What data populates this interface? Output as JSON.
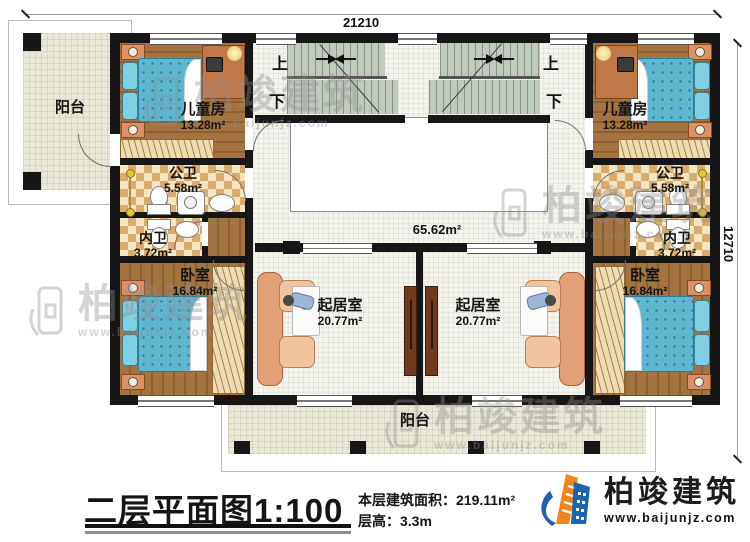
{
  "dimensions": {
    "top": "21210",
    "right": "12710"
  },
  "rooms": {
    "balcony_top": {
      "name": "阳台"
    },
    "balcony_bottom": {
      "name": "阳台"
    },
    "kids_left": {
      "name": "儿童房",
      "area": "13.28m²"
    },
    "kids_right": {
      "name": "儿童房",
      "area": "13.28m²"
    },
    "pub_bath_left": {
      "name": "公卫",
      "area": "5.58m²"
    },
    "pub_bath_right": {
      "name": "公卫",
      "area": "5.58m²"
    },
    "priv_bath_left": {
      "name": "内卫",
      "area": "3.72m²"
    },
    "priv_bath_right": {
      "name": "内卫",
      "area": "3.72m²"
    },
    "bedroom_left": {
      "name": "卧室",
      "area": "16.84m²"
    },
    "bedroom_right": {
      "name": "卧室",
      "area": "16.84m²"
    },
    "living_left": {
      "name": "起居室",
      "area": "20.77m²"
    },
    "living_right": {
      "name": "起居室",
      "area": "20.77m²"
    },
    "hall": {
      "area": "65.62m²"
    }
  },
  "stairs": {
    "up": "上",
    "down": "下"
  },
  "title_block": {
    "title": "二层平面图1:100",
    "area_label": "本层建筑面积：",
    "area_value": "219.11m²",
    "floor_height_label": "层高：",
    "floor_height_value": "3.3m"
  },
  "brand": {
    "name": "柏竣建筑",
    "website": "www.baijunjz.com"
  },
  "watermark": {
    "name": "柏竣建筑",
    "website": "www.baijunjz.com"
  },
  "colors": {
    "wall": "#161616",
    "wood": "#9c6d3b",
    "checker_tile": "#d9ac6e",
    "stair": "#bfcabd",
    "bed": "#5fb6cf",
    "balcony_tile": "#eae8d6",
    "brand_orange": "#f08519",
    "brand_blue": "#1e63ad",
    "watermark_gray": "#8f8f8f"
  }
}
